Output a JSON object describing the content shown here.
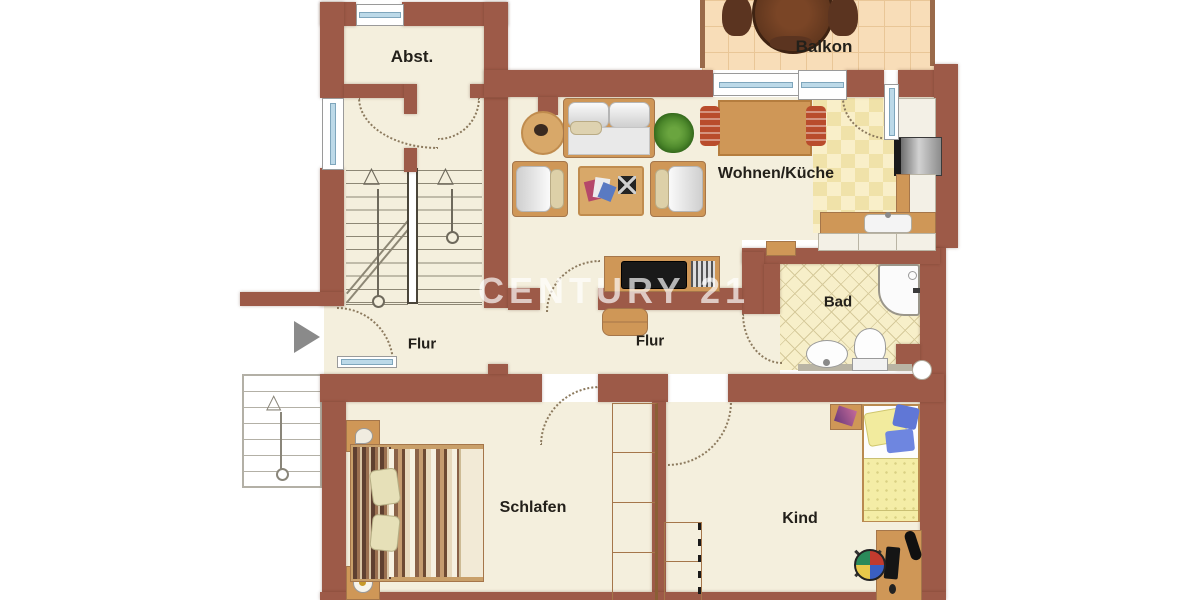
{
  "app": {
    "type": "apartment-floor-plan"
  },
  "watermark": {
    "text": "CENTURY 21",
    "color": "rgba(255,255,255,0.68)"
  },
  "rooms": {
    "abst": {
      "label": "Abst."
    },
    "balkon": {
      "label": "Balkon"
    },
    "wohnen": {
      "label": "Wohnen/Küche"
    },
    "bad": {
      "label": "Bad"
    },
    "flur_links": {
      "label": "Flur"
    },
    "flur_mitte": {
      "label": "Flur"
    },
    "schlafen": {
      "label": "Schlafen"
    },
    "kind": {
      "label": "Kind"
    }
  },
  "icons": {
    "entrance_arrow": "right-triangle",
    "stair_up_arrow": "△"
  },
  "palette": {
    "wall": "#9d5a48",
    "floor": "#f4efdd",
    "balcony_tile": "#f8ddb8",
    "kitchen_tile": "#f0e2a9",
    "bath_tile": "#f7efc9",
    "wood": "#cf9757",
    "wood_dark": "#5b3420",
    "glass": "#bcd9e8",
    "background": "#ffffff"
  }
}
